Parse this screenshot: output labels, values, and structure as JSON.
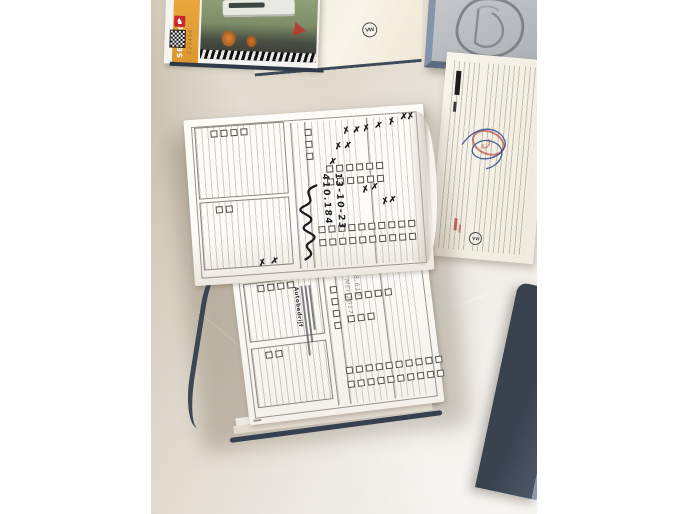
{
  "scene": {
    "description": "Top-down photo of an opened vehicle service booklet with pen check marks and handwritten entries on a light desk, beside an orange service booklet, a cream VW booklet cover, an embossed grey plaque, a stamped warranty document and a dark blue folder."
  },
  "icons": {
    "marks_glyph": "✗",
    "emblem_glyph": "♞"
  },
  "orange_booklet": {
    "spine_title": "SERVICE",
    "spine_code": "C23456"
  },
  "vw_booklet": {
    "logo_text": "VW"
  },
  "right_document": {
    "logo_text": "VW"
  },
  "open_booklet": {
    "top_page": {
      "handwriting_km": "410.184",
      "handwriting_date": "13-10-23",
      "x_marks": [
        {
          "x": 66,
          "y": 11,
          "r": -12
        },
        {
          "x": 70,
          "y": 11,
          "r": 8
        },
        {
          "x": 74,
          "y": 10,
          "r": -5
        },
        {
          "x": 79,
          "y": 9,
          "r": 14
        },
        {
          "x": 62,
          "y": 20,
          "r": -8
        },
        {
          "x": 66,
          "y": 20,
          "r": 10
        },
        {
          "x": 85,
          "y": 7,
          "r": -15
        },
        {
          "x": 90,
          "y": 5,
          "r": 6
        },
        {
          "x": 93,
          "y": 5,
          "r": -6
        },
        {
          "x": 59,
          "y": 29,
          "r": 12
        },
        {
          "x": 72,
          "y": 47,
          "r": -10
        },
        {
          "x": 76,
          "y": 46,
          "r": 7
        },
        {
          "x": 80,
          "y": 55,
          "r": -14
        },
        {
          "x": 83,
          "y": 54,
          "r": 9
        },
        {
          "x": 27,
          "y": 87,
          "r": -8
        },
        {
          "x": 32,
          "y": 86,
          "r": 12
        }
      ]
    },
    "bottom_page": {
      "stamp_name": "Autobedrijf",
      "handwriting_date": "23 MEI 2017",
      "handwriting_km": "158.619",
      "x_marks": []
    }
  },
  "colors": {
    "surface_light": "#f6f4f0",
    "surface_dark": "#c6bba7",
    "booklet_cover_navy": "#35414f",
    "orange_spine": "#e2a03b",
    "emblem_red": "#c5292f",
    "stamp_red": "#b9453c",
    "signature_blue": "#2c4a8c",
    "plaque_frame": "#8594aa",
    "page_white": "#fdfcf9"
  }
}
